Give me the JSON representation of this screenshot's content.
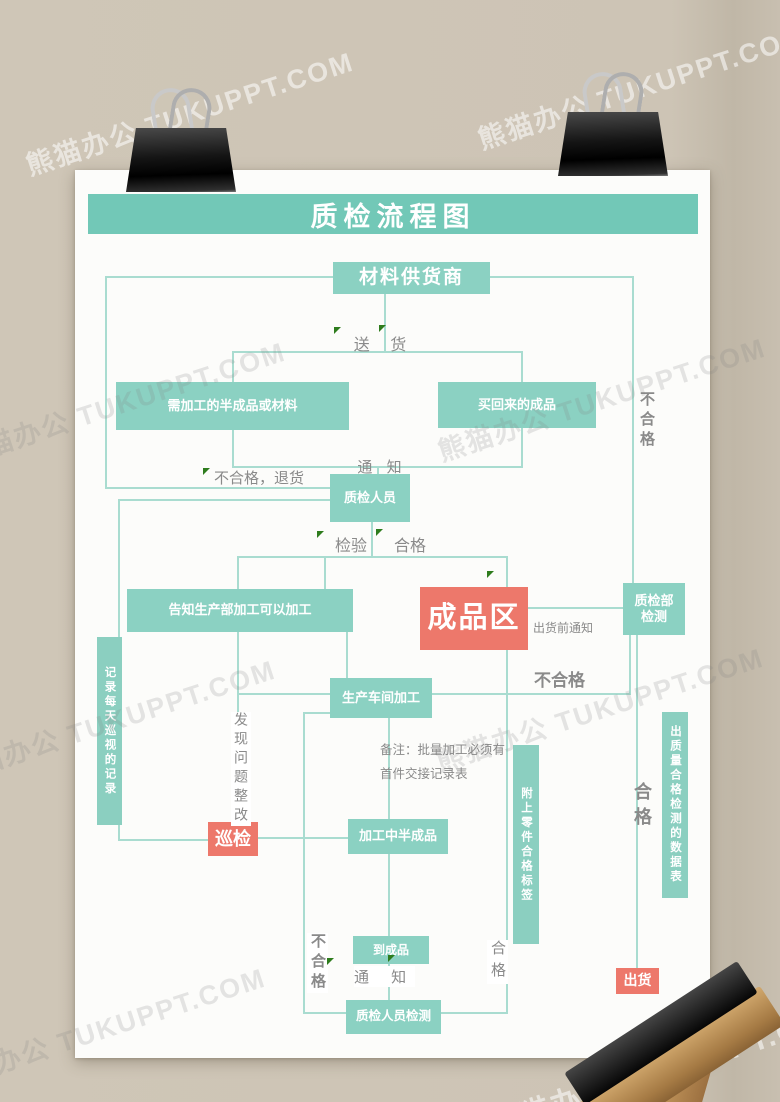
{
  "title": "质检流程图",
  "watermark": {
    "text": "熊猫办公 TUKUPPT.COM"
  },
  "colors": {
    "background": "#cdc4b5",
    "paper": "#fcfcfa",
    "banner_teal": "#72c8b7",
    "box_teal": "#8bd1c2",
    "bar_teal": "#8bcfc0",
    "accent_red": "#ed786b",
    "line_teal": "#a9dcd0",
    "label_gray": "#8a8a8a",
    "arrow_green": "#2e7c1d"
  },
  "nodes": {
    "supplier": "材料供货商",
    "semi": "需加工的半成品或材料",
    "bought": "买回来的成品",
    "inspector": "质检人员",
    "inform": "告知生产部加工可以加工",
    "finished_area": "成品区",
    "qc_dept": "质检部检测",
    "workshop": "生产车间加工",
    "mid_product": "加工中半成品",
    "patrol": "巡检",
    "to_finished": "到成品",
    "final_inspect": "质检人员检测",
    "ship": "出货"
  },
  "bars": {
    "record": "记录每天巡视的记录",
    "tag": "附上零件合格标签",
    "data": "出质量合格检测的数据表"
  },
  "labels": {
    "deliver": "送 货",
    "notify_top": "通 知",
    "reject_return": "不合格，退货",
    "inspect": "检验",
    "pass": "合格",
    "pre_ship_notice": "出货前通知",
    "fail_right_top": "不合格",
    "fail_mid": "不合格",
    "issue_fix": "发现问题整改",
    "note_line1": "备注：批量加工必须有",
    "note_line2": "首件交接记录表",
    "fail_left_bottom": "不合格",
    "notify_bottom": "通 知",
    "pass_bottom_mid": "合格",
    "pass_right": "合格"
  }
}
